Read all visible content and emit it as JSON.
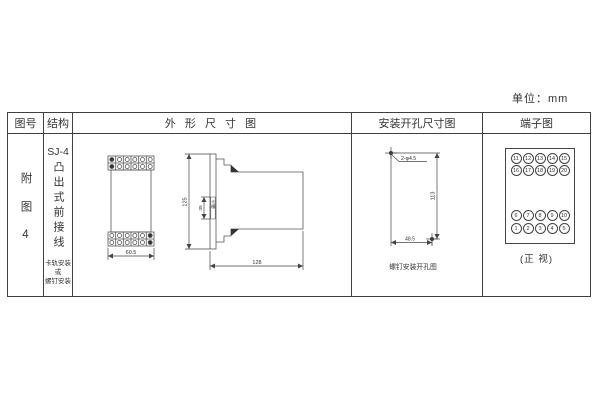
{
  "unit_label": "单位：mm",
  "table": {
    "headers": {
      "figure_no": "图号",
      "structure": "结构",
      "outline": "外 形 尺 寸 图",
      "mounting": "安装开孔尺寸图",
      "terminal": "端子图"
    }
  },
  "figure_cell": {
    "label": "附图4"
  },
  "structure_cell": {
    "model": "SJ-4",
    "type_vertical": "凸出式前接线",
    "note_line1": "卡轨安装",
    "note_line2": "或",
    "note_line3": "螺钉安装"
  },
  "outline_drawing": {
    "front_width": "60.5",
    "height": "125",
    "slot_dim": "35",
    "slot_label": "卡槽",
    "depth": "128"
  },
  "mounting_drawing": {
    "holes_label": "2-φ4.5",
    "vertical_dim": "113",
    "horizontal_dim": "48.5",
    "caption": "螺钉安装开孔图"
  },
  "terminal_diagram": {
    "rows": [
      [
        "11",
        "12",
        "13",
        "14",
        "15"
      ],
      [
        "16",
        "17",
        "18",
        "19",
        "20"
      ],
      [
        "6",
        "7",
        "8",
        "9",
        "10"
      ],
      [
        "1",
        "2",
        "3",
        "4",
        "5"
      ]
    ],
    "caption": "(正 视)"
  }
}
